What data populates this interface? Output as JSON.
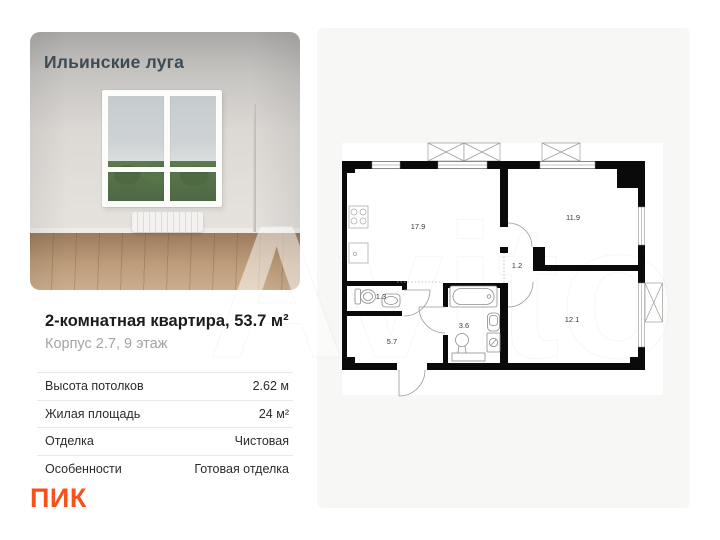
{
  "photo_card": {
    "project_label": "Ильинские луга"
  },
  "listing": {
    "title": "2-комнатная квартира, 53.7 м²",
    "subtitle": "Корпус 2.7, 9 этаж",
    "specs": [
      {
        "label": "Высота потолков",
        "value": "2.62 м"
      },
      {
        "label": "Жилая площадь",
        "value": "24 м²"
      },
      {
        "label": "Отделка",
        "value": "Чистовая"
      },
      {
        "label": "Особенности",
        "value": "Готовая отделка"
      }
    ]
  },
  "developer": {
    "logo_text": "ПИК",
    "brand_color": "#f7511c"
  },
  "floorplan": {
    "panel_color": "#f7f7f5",
    "rooms": [
      {
        "id": "kitchen-living",
        "area": "17.9"
      },
      {
        "id": "bedroom-1",
        "area": "11.9"
      },
      {
        "id": "corridor",
        "area": "1.2"
      },
      {
        "id": "wc",
        "area": "1.3"
      },
      {
        "id": "bathroom",
        "area": "3.6"
      },
      {
        "id": "hallway",
        "area": "5.7"
      },
      {
        "id": "bedroom-2",
        "area": "12.1"
      }
    ]
  },
  "watermark": {
    "text": "Avito"
  }
}
